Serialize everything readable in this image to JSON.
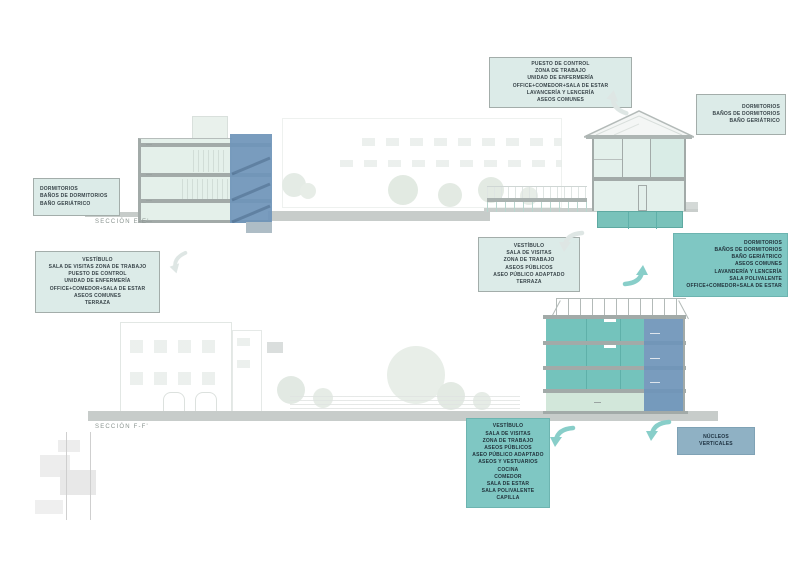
{
  "sections": {
    "ee_label": "SECCIÓN  E-E'",
    "ff_label": "SECCIÓN  F-F'"
  },
  "annotation_boxes": {
    "top_center": {
      "lines": [
        "PUESTO DE CONTROL",
        "ZONA DE TRABAJO",
        "UNIDAD DE ENFERMERÍA",
        "OFFICE+COMEDOR+SALA DE ESTAR",
        "LAVANCERÍA Y LENCERÍA",
        "ASEOS COMUNES"
      ]
    },
    "top_right": {
      "lines": [
        "DORMITORIOS",
        "BAÑOS DE DORMITORIOS",
        "BAÑO GERIÁTRICO"
      ]
    },
    "upper_left": {
      "lines": [
        "DORMITORIOS",
        "BAÑOS DE DORMITORIOS",
        "BAÑO GERIÁTRICO"
      ]
    },
    "mid_left": {
      "lines": [
        "VESTÍBULO",
        "SALA DE VISITAS ZONA DE TRABAJO",
        "PUESTO DE CONTROL",
        "UNIDAD DE ENFERMERÍA",
        "OFFICE+COMEDOR+SALA DE ESTAR",
        "ASEOS COMUNES",
        "TERRAZA"
      ]
    },
    "mid_center": {
      "lines": [
        "VESTÍBULO",
        "SALA DE VISITAS",
        "ZONA DE TRABAJO",
        "ASEOS PÚBLICOS",
        "ASEO PÚBLICO ADAPTADO",
        "TERRAZA"
      ]
    },
    "mid_right": {
      "lines": [
        "DORMITORIOS",
        "BAÑOS DE DORMITORIOS",
        "BAÑO GERIÁTRICO",
        "ASEOS COMUNES",
        "LAVANDERÍA Y LENCERÍA",
        "SALA POLIVALENTE",
        "OFFICE+COMEDOR+SALA DE ESTAR"
      ]
    },
    "bottom_center": {
      "lines": [
        "VESTÍBULO",
        "SALA DE VISITAS",
        "ZONA DE TRABAJO",
        "ASEOS PÚBLICOS",
        "ASEO PÚBLICO ADAPTADO",
        "ASEOS Y VESTUARIOS",
        "COCINA",
        "COMEDOR",
        "SALA DE ESTAR",
        "SALA POLIVALENTE",
        "CAPILLA"
      ]
    },
    "cores": {
      "lines": [
        "NÚCLEOS",
        "VERTICALES"
      ]
    }
  },
  "arrows": [
    {
      "id": "a1",
      "color": "gray",
      "direction": "up-left"
    },
    {
      "id": "a2",
      "color": "gray",
      "direction": "left"
    },
    {
      "id": "a3",
      "color": "gray",
      "direction": "down-left"
    },
    {
      "id": "a4",
      "color": "teal",
      "direction": "up-right"
    },
    {
      "id": "a5",
      "color": "teal",
      "direction": "down-left"
    },
    {
      "id": "a6",
      "color": "teal",
      "direction": "down-left"
    }
  ],
  "colors": {
    "light_box_bg": "#dcebe8",
    "dark_box_bg": "#7fc7c3",
    "blue_box_bg": "#8fb1c4",
    "core_blue": "#6f95ba",
    "floor_teal": "#74c3bc",
    "pale_interior": "#e4f0ea",
    "slab_gray": "#a2aaa8",
    "ground_gray": "#c7ccca",
    "arrow_teal": "#88cec9",
    "arrow_gray": "#dee6e4"
  }
}
